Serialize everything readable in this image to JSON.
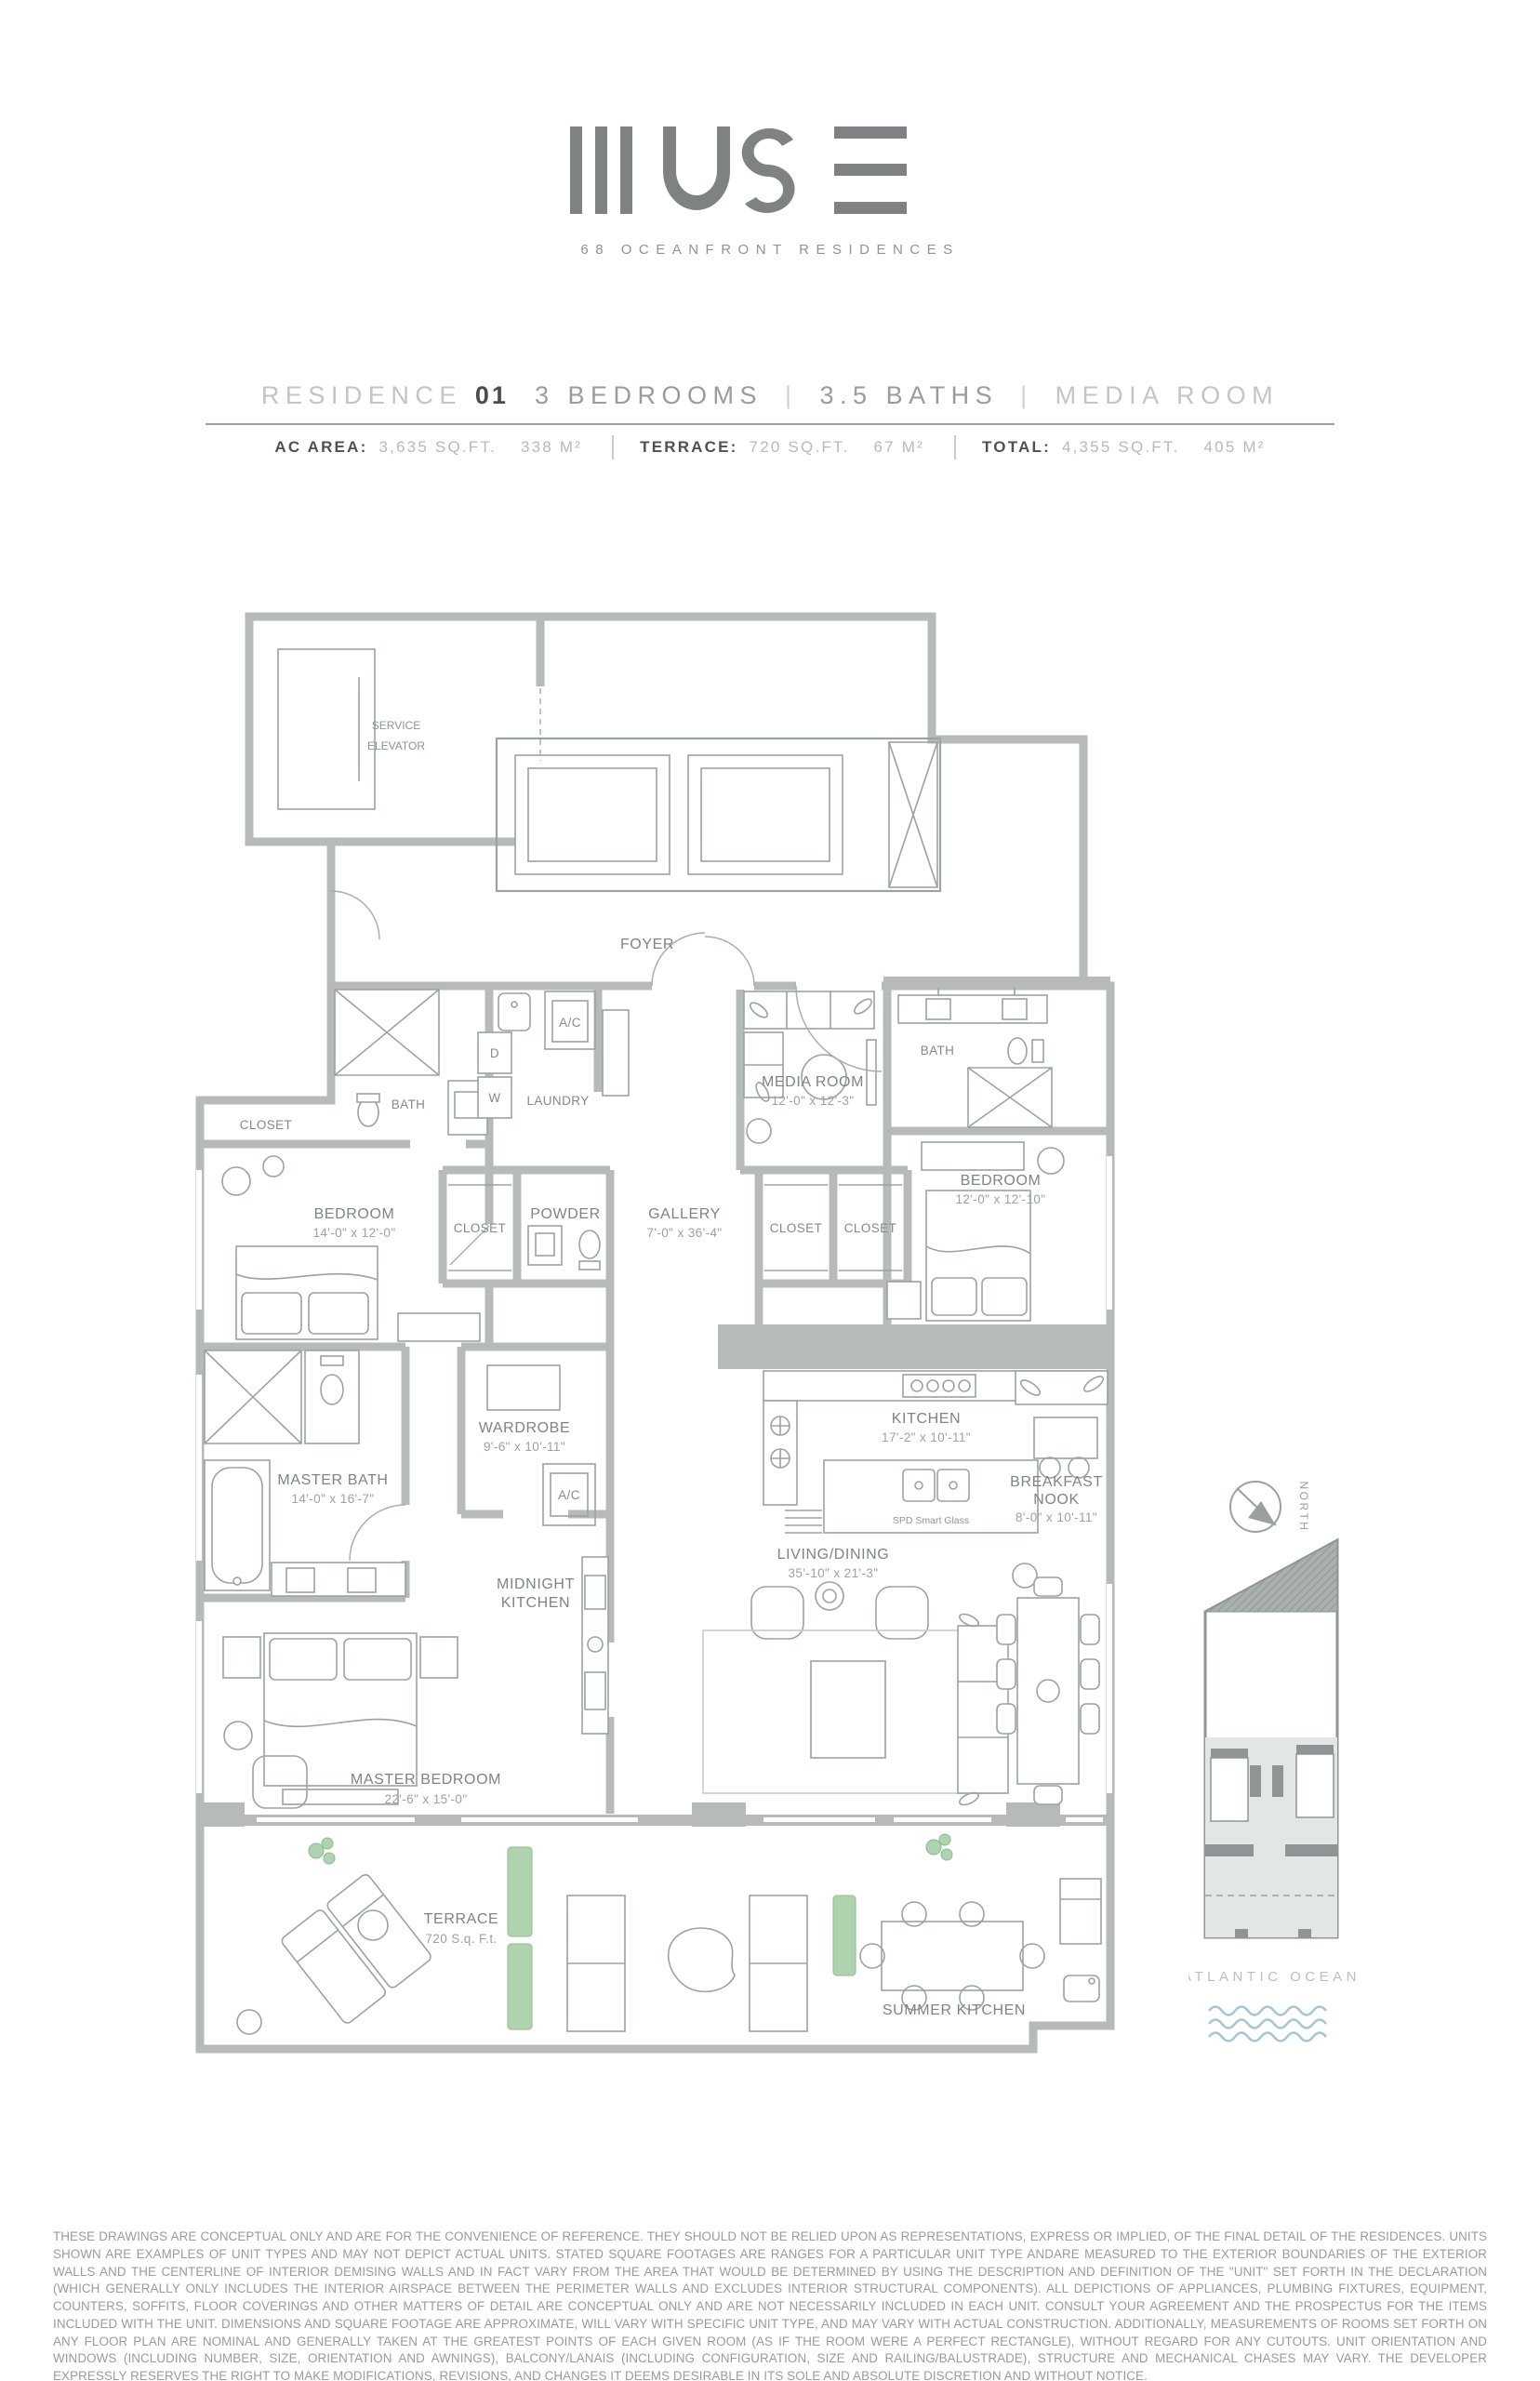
{
  "colors": {
    "wall": "#b6bbba",
    "line": "#9aa3a2",
    "label": "#7d8584",
    "plant_green": "#9ccb9c",
    "wave_blue": "#a5c4d6",
    "accent_dark": "#4b4c4c"
  },
  "brand": {
    "name": "MUSE",
    "tagline": "68 OCEANFRONT RESIDENCES"
  },
  "header": {
    "residence_label": "RESIDENCE",
    "residence_number": "01",
    "bedrooms": "3 BEDROOMS",
    "sep1": "|",
    "baths": "3.5 BATHS",
    "sep2": "|",
    "extra": "MEDIA ROOM"
  },
  "specs": {
    "ac_label": "AC AREA:",
    "ac_sqft": "3,635 SQ.FT.",
    "ac_m2": "338 M²",
    "terrace_label": "TERRACE:",
    "terrace_sqft": "720 SQ.FT.",
    "terrace_m2": "67 M²",
    "total_label": "TOTAL:",
    "total_sqft": "4,355 SQ.FT.",
    "total_m2": "405 M²"
  },
  "plan": {
    "rooms": {
      "service_elevator": {
        "line1": "SERVICE",
        "line2": "ELEVATOR"
      },
      "foyer": {
        "name": "FOYER"
      },
      "bath_1": {
        "name": "BATH"
      },
      "laundry": {
        "name": "LAUNDRY"
      },
      "dryer": {
        "name": "D"
      },
      "washer": {
        "name": "W"
      },
      "ac_1": {
        "name": "A/C"
      },
      "closet_1": {
        "name": "CLOSET"
      },
      "media_room": {
        "name": "MEDIA ROOM",
        "dims": "12'-0\" x 12'-3\""
      },
      "bath_2": {
        "name": "BATH"
      },
      "bedroom_2": {
        "name": "BEDROOM",
        "dims": "14'-0\" x 12'-0\""
      },
      "bedroom_3": {
        "name": "BEDROOM",
        "dims": "12'-0\" x 12'-10\""
      },
      "closet_2": {
        "name": "CLOSET"
      },
      "powder": {
        "name": "POWDER"
      },
      "gallery": {
        "name": "GALLERY",
        "dims": "7'-0\" x 36'-4\""
      },
      "closet_3": {
        "name": "CLOSET"
      },
      "closet_4": {
        "name": "CLOSET"
      },
      "wardrobe": {
        "name": "WARDROBE",
        "dims": "9'-6\" x 10'-11\""
      },
      "kitchen": {
        "name": "KITCHEN",
        "dims": "17'-2\" x 10'-11\""
      },
      "spd_note": {
        "name": "SPD Smart Glass"
      },
      "breakfast_nook": {
        "line1": "BREAKFAST",
        "line2": "NOOK",
        "dims": "8'-0\" x 10'-11\""
      },
      "master_bath": {
        "name": "MASTER BATH",
        "dims": "14'-0\" x 16'-7\""
      },
      "ac_2": {
        "name": "A/C"
      },
      "midnight_kitchen": {
        "line1": "MIDNIGHT",
        "line2": "KITCHEN"
      },
      "living_dining": {
        "name": "LIVING/DINING",
        "dims": "35'-10\" x 21'-3\""
      },
      "master_bedroom": {
        "name": "MASTER BEDROOM",
        "dims": "22'-6\" x 15'-0\""
      },
      "terrace": {
        "name": "TERRACE",
        "dims": "720 S.q. F.t."
      },
      "summer_kitchen": {
        "name": "SUMMER KITCHEN"
      }
    }
  },
  "keyplan": {
    "north_label": "NORTH",
    "ocean_label": "ATLANTIC OCEAN"
  },
  "disclaimer": "THESE DRAWINGS ARE CONCEPTUAL ONLY AND ARE FOR THE CONVENIENCE OF REFERENCE. THEY SHOULD NOT BE RELIED UPON AS REPRESENTATIONS, EXPRESS OR IMPLIED, OF THE FINAL DETAIL OF THE RESIDENCES. UNITS SHOWN ARE EXAMPLES OF UNIT TYPES AND MAY NOT DEPICT ACTUAL UNITS. STATED SQUARE FOOTAGES ARE RANGES FOR A PARTICULAR UNIT TYPE ANDARE MEASURED TO THE EXTERIOR BOUNDARIES OF THE EXTERIOR WALLS AND THE CENTERLINE OF INTERIOR DEMISING WALLS AND IN FACT VARY FROM THE AREA THAT WOULD BE DETERMINED BY USING THE DESCRIPTION AND DEFINITION OF THE \"UNIT\" SET FORTH IN THE DECLARATION (WHICH GENERALLY ONLY INCLUDES THE INTERIOR AIRSPACE BETWEEN THE PERIMETER WALLS AND EXCLUDES INTERIOR STRUCTURAL COMPONENTS). ALL DEPICTIONS OF APPLIANCES, PLUMBING FIXTURES, EQUIPMENT, COUNTERS, SOFFITS, FLOOR COVERINGS AND OTHER MATTERS OF DETAIL ARE CONCEPTUAL ONLY AND ARE NOT NECESSARILY INCLUDED IN EACH UNIT. CONSULT YOUR AGREEMENT AND THE PROSPECTUS FOR THE ITEMS INCLUDED WITH THE UNIT. DIMENSIONS AND SQUARE FOOTAGE ARE APPROXIMATE, WILL VARY WITH SPECIFIC UNIT TYPE, AND MAY VARY WITH ACTUAL CONSTRUCTION. ADDITIONALLY, MEASUREMENTS OF ROOMS SET FORTH ON ANY FLOOR PLAN ARE NOMINAL AND GENERALLY TAKEN AT THE GREATEST POINTS OF EACH GIVEN ROOM (AS IF THE ROOM WERE A PERFECT RECTANGLE), WITHOUT REGARD FOR ANY CUTOUTS. UNIT ORIENTATION AND WINDOWS (INCLUDING NUMBER, SIZE, ORIENTATION AND AWNINGS), BALCONY/LANAIS (INCLUDING CONFIGURATION, SIZE AND RAILING/BALUSTRADE), STRUCTURE AND MECHANICAL CHASES MAY VARY. THE DEVELOPER EXPRESSLY RESERVES THE RIGHT TO MAKE MODIFICATIONS, REVISIONS, AND CHANGES IT DEEMS DESIRABLE IN ITS SOLE AND ABSOLUTE DISCRETION AND WITHOUT NOTICE."
}
